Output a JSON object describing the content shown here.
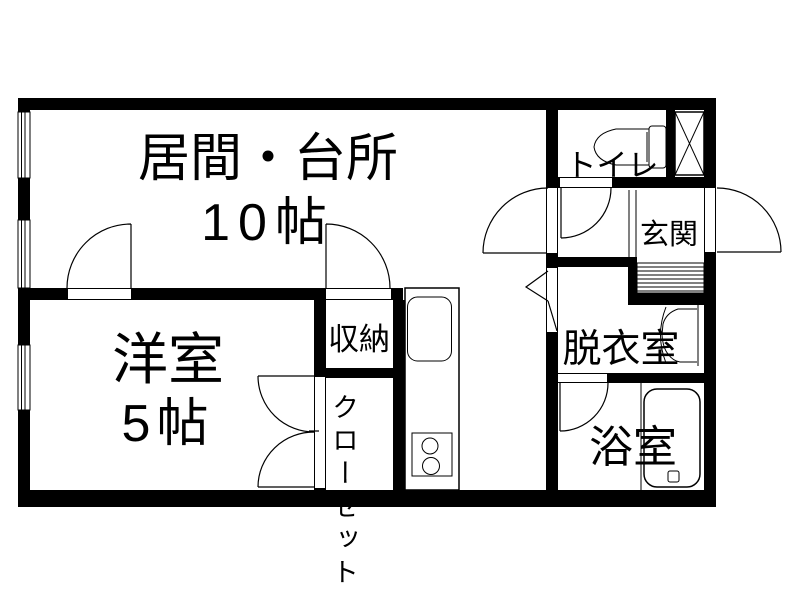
{
  "floor_plan": {
    "rooms": {
      "living_kitchen": {
        "name": "居間・台所",
        "size": "10帖"
      },
      "western_room": {
        "name": "洋室",
        "size": "5帖"
      },
      "storage": {
        "name": "収納"
      },
      "closet": {
        "name": "クローゼット"
      },
      "toilet": {
        "name": "トイレ"
      },
      "entrance": {
        "name": "玄関"
      },
      "dressing_room": {
        "name": "脱衣室"
      },
      "bathroom": {
        "name": "浴室"
      }
    },
    "fixtures": {
      "kitchen_sink": "kitchen-sink-icon",
      "gas_stove": "gas-stove-icon",
      "bathtub": "bathtub-icon",
      "toilet_bowl": "toilet-bowl-icon",
      "washbasin": "washbasin-icon",
      "meter_box": "meter-box-icon",
      "entrance_step": "entrance-step-hatch"
    },
    "colors": {
      "wall": "#000000",
      "background": "#ffffff",
      "line": "#000000"
    }
  }
}
